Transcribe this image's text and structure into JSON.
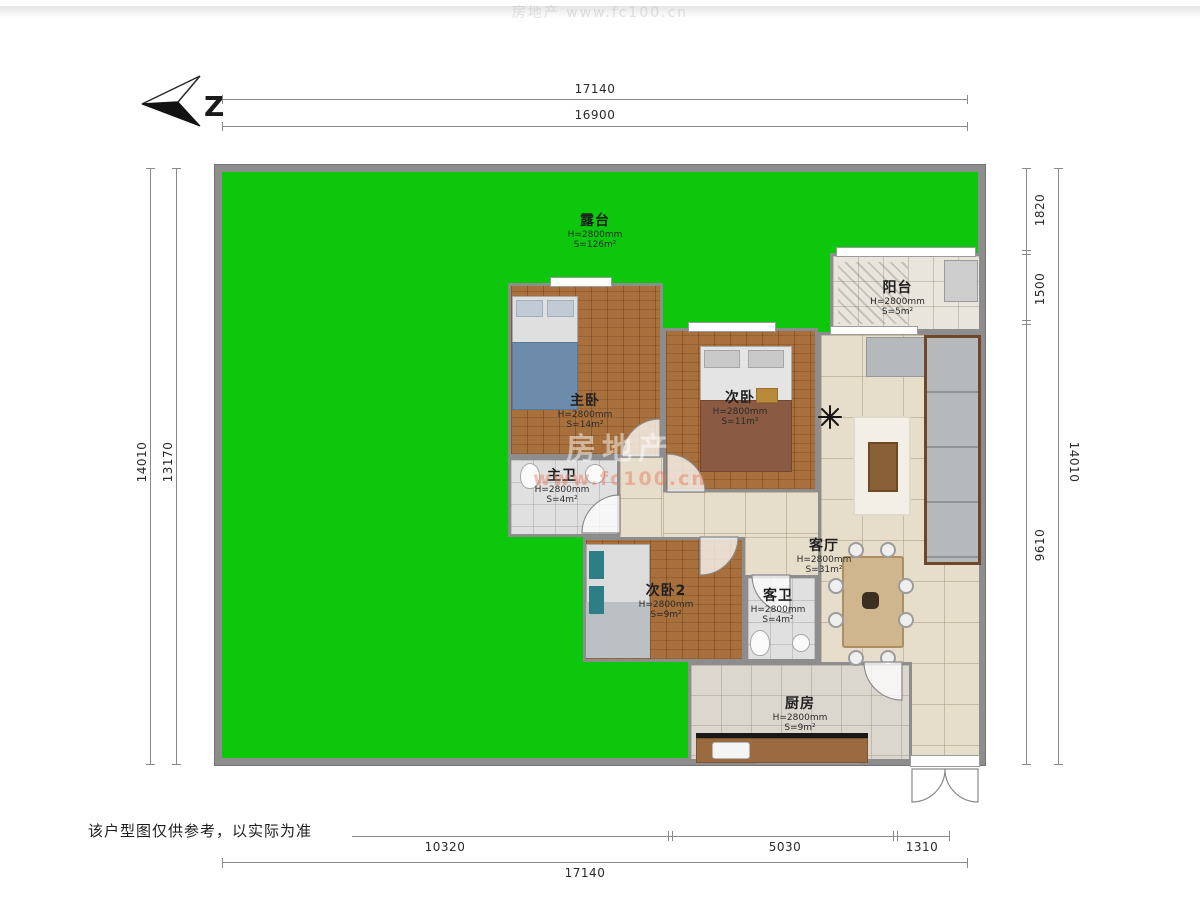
{
  "compass": {
    "label": "Z"
  },
  "dims": {
    "top": [
      "17140",
      "16900"
    ],
    "left": [
      "14010",
      "13170"
    ],
    "right": [
      "1820",
      "1500",
      "9610",
      "14010"
    ],
    "bottom": [
      "10320",
      "5030",
      "1310",
      "17140"
    ]
  },
  "rooms": [
    {
      "id": "terrace",
      "name": "露台",
      "height": "H=2800mm",
      "area": "S=126m²"
    },
    {
      "id": "balcony",
      "name": "阳台",
      "height": "H=2800mm",
      "area": "S=5m²"
    },
    {
      "id": "master-bedroom",
      "name": "主卧",
      "height": "H=2800mm",
      "area": "S=14m²"
    },
    {
      "id": "bedroom-2",
      "name": "次卧",
      "height": "H=2800mm",
      "area": "S=11m²"
    },
    {
      "id": "master-bathroom",
      "name": "主卫",
      "height": "H=2800mm",
      "area": "S=4m²"
    },
    {
      "id": "bedroom-3",
      "name": "次卧2",
      "height": "H=2800mm",
      "area": "S=9m²"
    },
    {
      "id": "guest-bathroom",
      "name": "客卫",
      "height": "H=2800mm",
      "area": "S=4m²"
    },
    {
      "id": "living-room",
      "name": "客厅",
      "height": "H=2800mm",
      "area": "S=31m²"
    },
    {
      "id": "kitchen",
      "name": "厨房",
      "height": "H=2800mm",
      "area": "S=9m²"
    }
  ],
  "watermark": {
    "brand": "房地产",
    "url": "www.fc100.cn"
  },
  "footer": {
    "disclaimer": "该户型图仅供参考，以实际为准"
  },
  "colors": {
    "terrace_green": "#0cc70c",
    "wall_gray": "#8d8d8d",
    "wood_floor": "#a8703c",
    "tile_beige": "#e7ddcb"
  }
}
